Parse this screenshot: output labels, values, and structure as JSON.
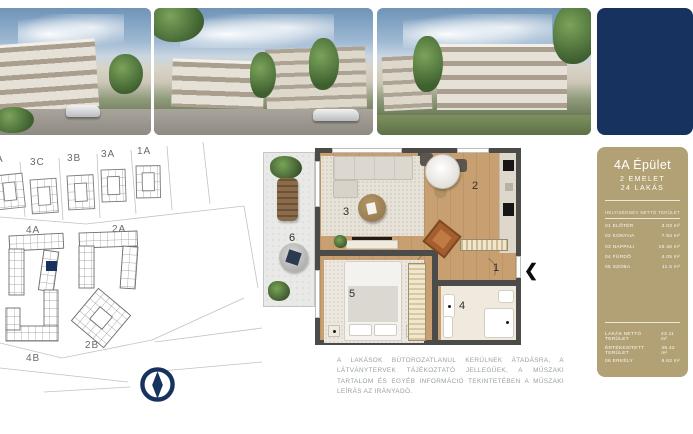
{
  "brand": {
    "navy": "#17325f",
    "tan": "#b2a175"
  },
  "photos": {
    "items": [
      "building-exterior-render-1",
      "building-exterior-render-2",
      "building-exterior-render-3"
    ]
  },
  "sidebar": {
    "title": "4A Épület",
    "subtitle_floor": "2 EMELET",
    "subtitle_units": "24 LAKÁS",
    "table": {
      "header_name": "HELYISÉGNÉV",
      "header_area": "NETTÓ TERÜLET",
      "rows": [
        {
          "label": "01 ELŐTÉR",
          "value": "3.03 m²"
        },
        {
          "label": "02 KONYHA",
          "value": "7.94 m²"
        },
        {
          "label": "03 NAPPALI",
          "value": "16.46 m²"
        },
        {
          "label": "04 FÜRDŐ",
          "value": "4.05 m²"
        },
        {
          "label": "05 SZOBA",
          "value": "11.5 m²"
        }
      ],
      "summary": [
        {
          "label": "LAKÁS NETTÓ TERÜLET",
          "value": "43.11 m²"
        },
        {
          "label": "ÉRTÉKESÍTETT TERÜLET",
          "value": "46.42 m²"
        },
        {
          "label": "06 ERKÉLY",
          "value": "6.62 m²"
        }
      ]
    }
  },
  "siteplan": {
    "labels": [
      "A",
      "3C",
      "3B",
      "3A",
      "1A",
      "4A",
      "2A",
      "4B",
      "2B"
    ],
    "highlight_color": "#17325f"
  },
  "floorplan": {
    "rooms": [
      "1",
      "2",
      "3",
      "4",
      "5",
      "6"
    ],
    "entrance_arrow": "❮"
  },
  "disclaimer": "A LAKÁSOK BÚTOROZATLANUL KERÜLNEK ÁTADÁSRA, A LÁTVÁNYTERVEK TÁJÉKOZTATÓ JELLEGŰEK, A MŰSZAKI TARTALOM ÉS EGYÉB INFORMÁCIÓ TEKINTETÉBEN A MŰSZAKI LEÍRÁS AZ IRÁNYADÓ."
}
